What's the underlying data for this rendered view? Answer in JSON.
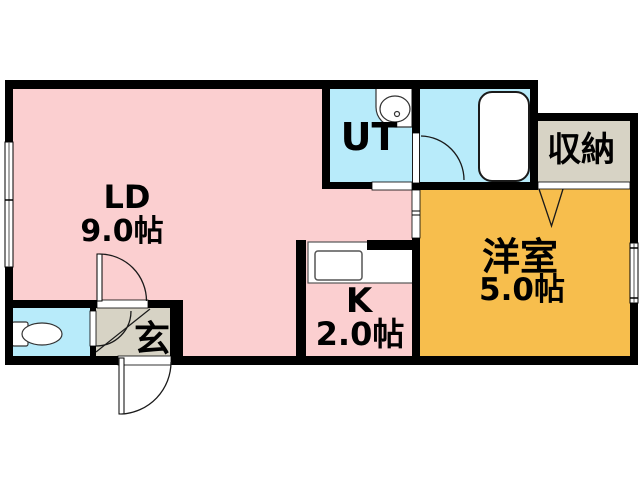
{
  "plan": {
    "type": "apartment-floor-plan",
    "background": "#ffffff",
    "wall_color": "#000000",
    "rooms": {
      "living_dining": {
        "label": "LD",
        "size": "9.0帖",
        "color": "#fbcfd0"
      },
      "kitchen": {
        "label": "K",
        "size": "2.0帖",
        "color": "#fbcfd0"
      },
      "western_room": {
        "label": "洋室",
        "size": "5.0帖",
        "color": "#f7be4d"
      },
      "utility": {
        "label": "UT",
        "color": "#b8ebfa"
      },
      "bathroom": {
        "color": "#b8ebfa"
      },
      "toilet": {
        "color": "#b8ebfa"
      },
      "storage": {
        "label": "収納",
        "color": "#d7d3c5"
      },
      "entrance": {
        "label": "玄",
        "color": "#d7d3c5"
      }
    }
  }
}
